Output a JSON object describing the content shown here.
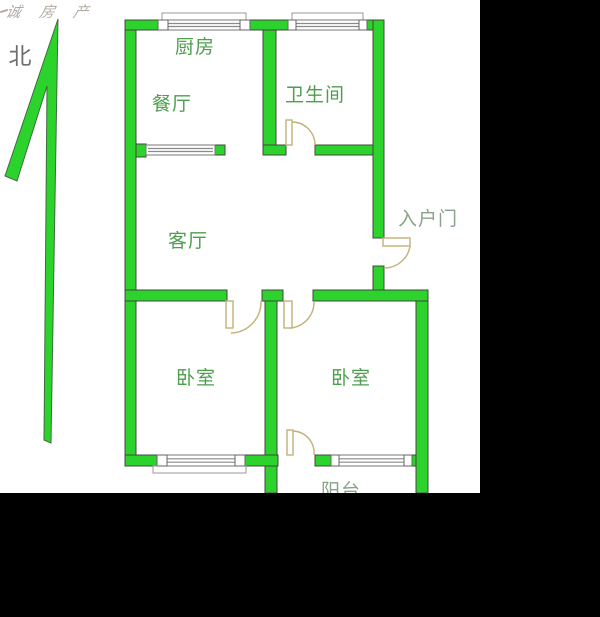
{
  "watermark": {
    "text": "诚 房 产"
  },
  "compass": {
    "north_label": "北"
  },
  "rooms": {
    "kitchen": "厨房",
    "dining_room": "餐厅",
    "bathroom": "卫生间",
    "living_room": "客厅",
    "entry_door": "入户门",
    "bedroom_left": "卧室",
    "bedroom_right": "卧室",
    "balcony": "阳台"
  },
  "colors": {
    "wall_fill": "#2cd32c",
    "wall_outline": "#44443c",
    "door_swing": "#c2b178",
    "room_label_green": "#4d9e4d",
    "secondary_label": "#8aa28a",
    "background": "#ffffff",
    "letterbox": "#000000"
  }
}
